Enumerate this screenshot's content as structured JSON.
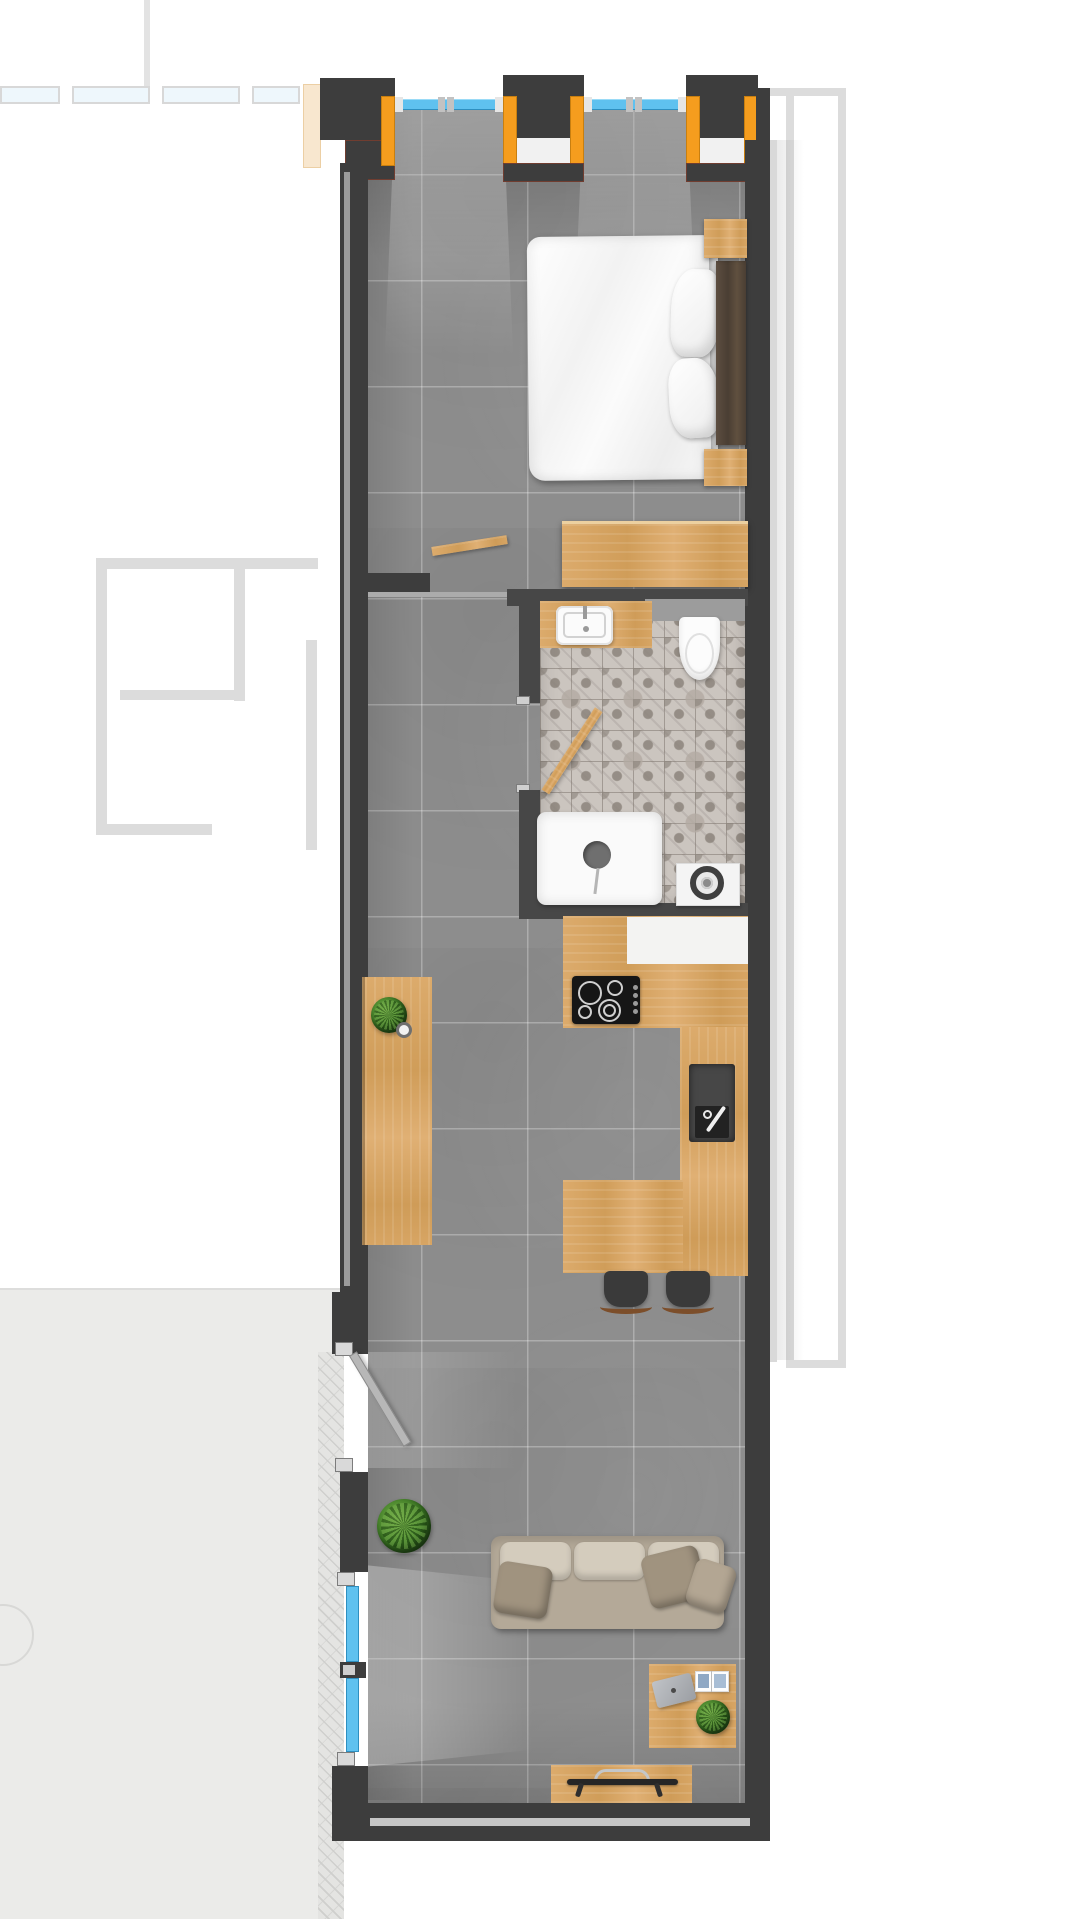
{
  "title": "Narrow studio apartment floor plan (top-down render, no visible text)",
  "palette": {
    "wall_dark": "#3d3d3d",
    "wall_inner": "#474747",
    "floor_tile_gray": "#8d8d8d",
    "wood_light": "#d5a261",
    "wood_dark_headboard": "#54463a",
    "accent_window_frame_orange": "#f59d1e",
    "window_glass_blue": "#5fc1ef",
    "bathroom_tile": "#cbc5bf",
    "bedding_white": "#f5f5f5",
    "sofa_taupe": "#b4a998",
    "plant_green": "#3c7a24",
    "terrace_concrete": "#ebebe9",
    "context_outline_gray": "#dcdcdc"
  },
  "rooms": {
    "bedroom": {
      "items": [
        "double-bed",
        "duvet",
        "mattress",
        "pillow",
        "pillow",
        "dark-wood-headboard",
        "nightstand-upper",
        "nightstand-lower",
        "low-dresser"
      ]
    },
    "bathroom": {
      "items": [
        "wood-vanity",
        "washbasin",
        "toilet",
        "patterned-tile-floor",
        "walk-in-shower",
        "shower-drain",
        "washing-machine",
        "swing-door"
      ]
    },
    "kitchen": {
      "items": [
        "l-shaped-wood-counter",
        "white-worktop-inset",
        "induction-cooktop-4-burners",
        "dark-kitchen-sink",
        "breakfast-peninsula",
        "bar-stool",
        "bar-stool"
      ]
    },
    "hallway": {
      "items": [
        "wood-sideboard",
        "small-potted-plant",
        "candle",
        "interior-swing-door",
        "entry-door"
      ]
    },
    "living_room": {
      "items": [
        "three-seat-sofa",
        "back-cushions",
        "throw-pillows",
        "floor-plant",
        "wood-desk",
        "laptop",
        "open-magazine",
        "desk-plant",
        "tv-bench",
        "flat-tv-top-view"
      ]
    },
    "exterior": {
      "items": [
        "terrace",
        "herringbone-decking",
        "neighbor-wall-outlines",
        "facade-window-bays"
      ]
    }
  },
  "windows": {
    "top_facade_bays": 2,
    "terrace_side_panes": 2,
    "frame_color": "#f59d1e",
    "glass_color": "#5fc1ef"
  }
}
